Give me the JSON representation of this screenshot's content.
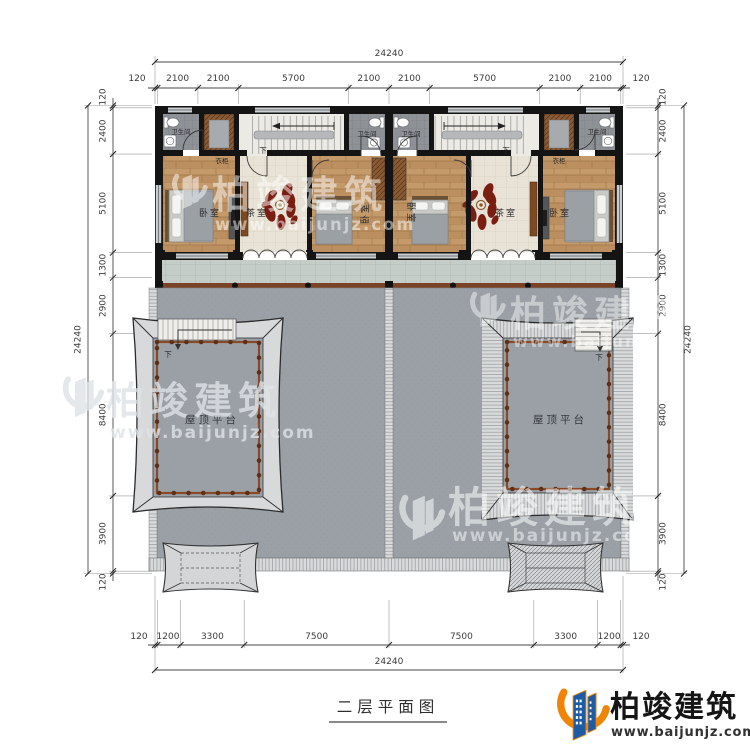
{
  "drawing": {
    "title": "二层平面图"
  },
  "branding": {
    "company": "柏竣建筑",
    "website": "www.baijunjz.com"
  },
  "watermark": {
    "company": "柏竣建筑",
    "website": "www.baijunjz.com"
  },
  "labels": {
    "bathroom": "卫生间",
    "closet": "衣柜",
    "bedroom": "卧室",
    "tea_room": "茶室",
    "roof_terrace": "屋顶平台",
    "down": "下"
  },
  "dimensions": {
    "top": {
      "total": "24240",
      "segments": [
        "120",
        "2100",
        "2100",
        "5700",
        "2100",
        "2100",
        "5700",
        "2100",
        "2100",
        "120"
      ]
    },
    "bottom": {
      "total": "24240",
      "segments": [
        "120",
        "1200",
        "3300",
        "7500",
        "7500",
        "3300",
        "1200",
        "120"
      ]
    },
    "left": {
      "total": "24240",
      "segments": [
        "120",
        "2400",
        "5100",
        "1300",
        "2900",
        "8400",
        "3900",
        "120"
      ]
    },
    "right": {
      "total": "24240",
      "segments": [
        "120",
        "2400",
        "5100",
        "1300",
        "2900",
        "8400",
        "3900",
        "120"
      ]
    }
  },
  "colors": {
    "wall": "#141414",
    "wood_floor": "#c49a6b",
    "tea_floor": "#e8e3d6",
    "terrace": "#9aa0a6",
    "railing_brown": "#7a4226",
    "accent_red": "#7a1e12",
    "logo_blue": "#1d5ba5",
    "logo_orange": "#f08505"
  }
}
